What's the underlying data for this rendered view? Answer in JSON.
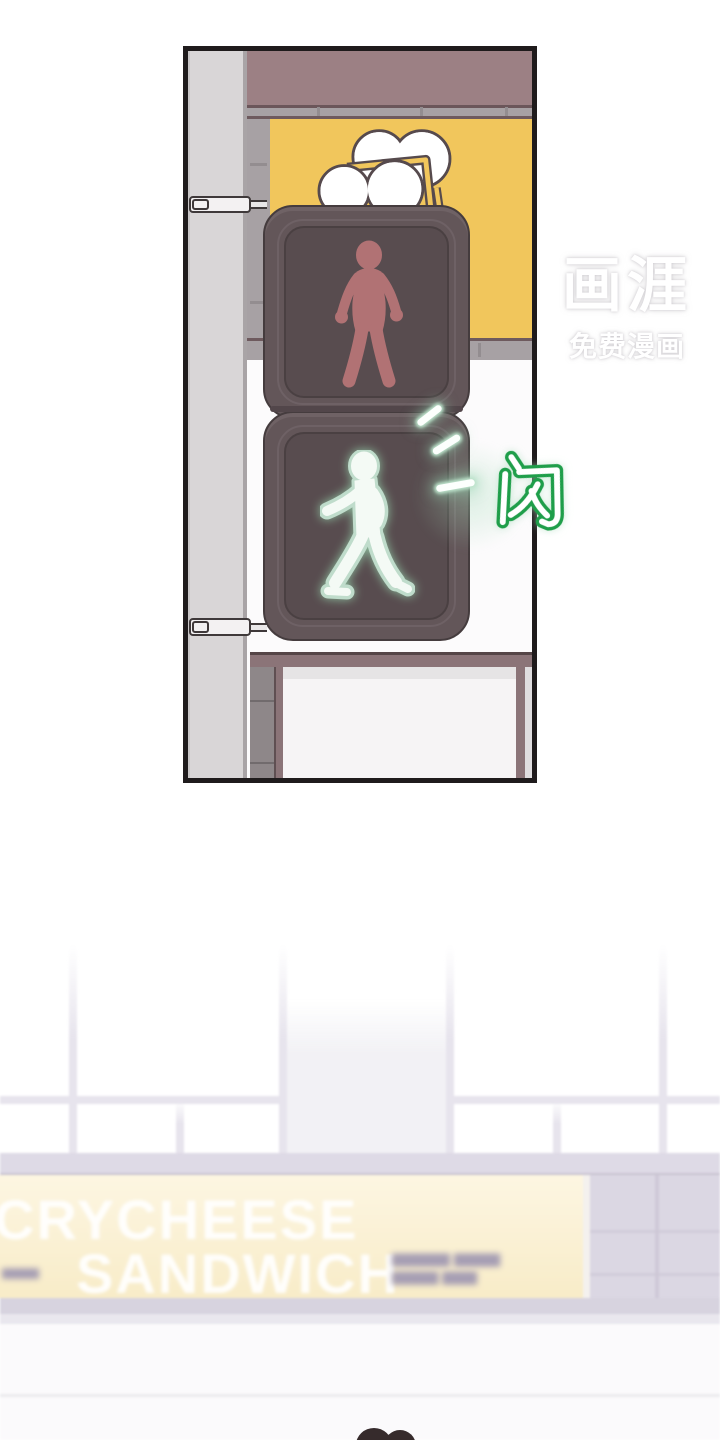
{
  "watermark": {
    "brand": "画涯",
    "tagline": "免费漫画",
    "color": "#ffffff"
  },
  "sfx": {
    "flash_char": "闪",
    "flash_color": "#1f9e4a"
  },
  "traffic_light": {
    "top_figure": "standing-person-red",
    "bottom_figure": "walking-person-lit",
    "colors": {
      "housing": "#635659",
      "screen": "#584c4f",
      "red_figure": "#b17274",
      "lit_figure": "#f4faf5",
      "lit_glow": "#bfdccb"
    }
  },
  "billboard": {
    "motif": "cloud-logo",
    "background": "#f1c65c"
  },
  "storefront": {
    "sign_line1": "CRYCHEESE",
    "sign_line2": "SANDWICH",
    "blurred_text_right_row1": "▆▆▆▆▆ ▆▆▆▆",
    "blurred_text_right_row2": "▆▆▆▆ ▆▆▆",
    "blurred_text_left": "▆▆▆▆",
    "sign_background_top": "#fdf6e2",
    "sign_background_bottom": "#f8ecc8",
    "fascia_color": "#dedae6"
  },
  "scene": {
    "pole_color": "#d9d6d7",
    "wall_band_color": "#9c8084",
    "brick_color": "#a7a1a4",
    "panel_border": "#1f1b1c",
    "pedestrian_head_color": "#362b2c"
  }
}
